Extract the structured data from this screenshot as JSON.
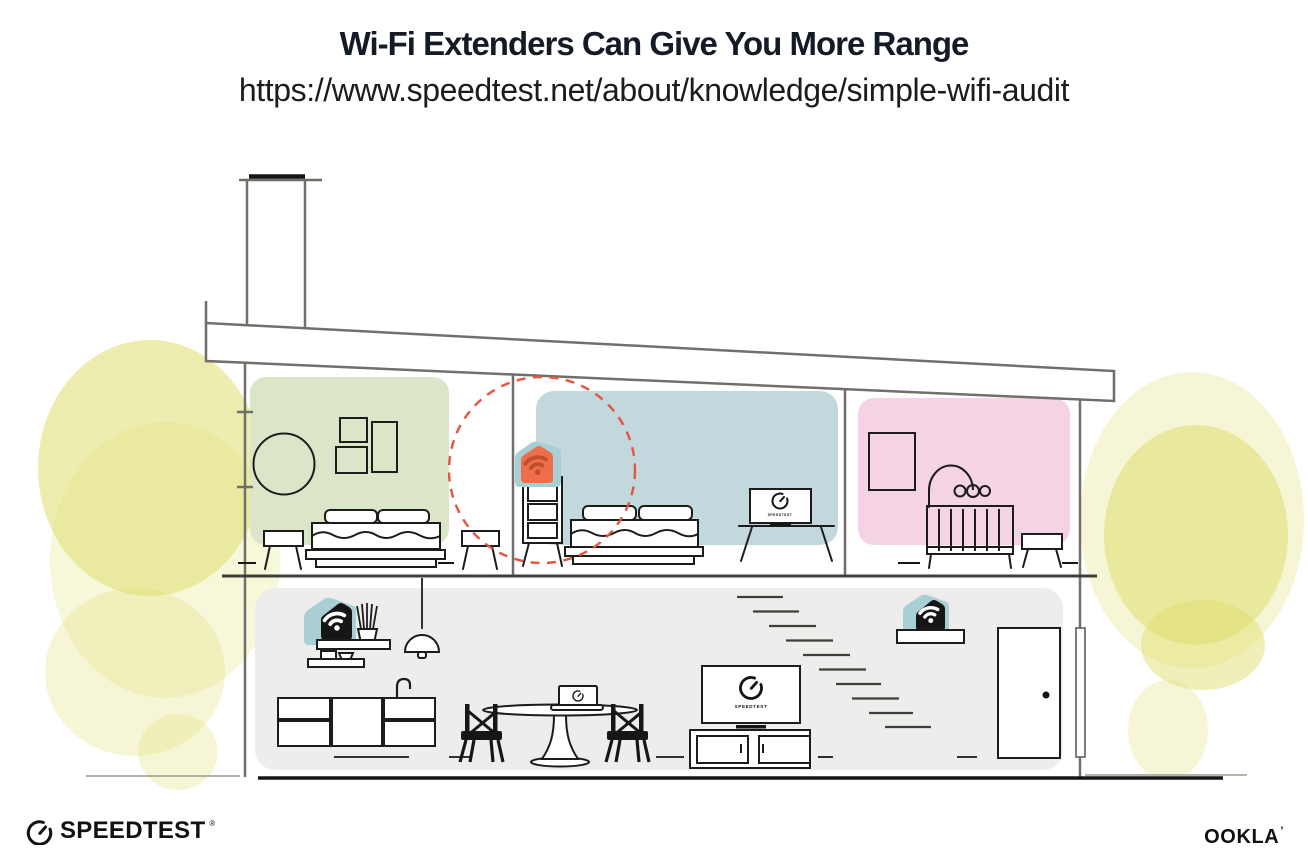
{
  "header": {
    "title": "Wi-Fi Extenders Can Give You More Range",
    "url": "https://www.speedtest.net/about/knowledge/simple-wifi-audit"
  },
  "footer": {
    "speedtest_logo_text": "SPEEDTEST",
    "speedtest_reg_mark": "®",
    "ookla_logo_text": "OOKLA",
    "ookla_mark": "’"
  },
  "illustration": {
    "screens": {
      "bedroom_tv_label": "SPEEDTEST",
      "living_room_tv_label": "SPEEDTEST"
    },
    "icons": {
      "wifi_icon": "wifi-arcs",
      "gauge_icon": "speedtest-gauge"
    },
    "colors": {
      "green_room": "#dbe6c8",
      "blue_room": "#c3d8dc",
      "pink_room": "#f3d3e4",
      "lower_floor": "#efedeb",
      "device_teal": "#a9ced3",
      "extender_orange": "#ee6e4b",
      "extender_wifi_accent": "#c14f2a",
      "coverage_red": "#e35540",
      "tree_yellow": "#dfdf70",
      "wall_gray": "#716f69",
      "line_ink": "#1c1c1c",
      "device_black": "#161616"
    }
  }
}
